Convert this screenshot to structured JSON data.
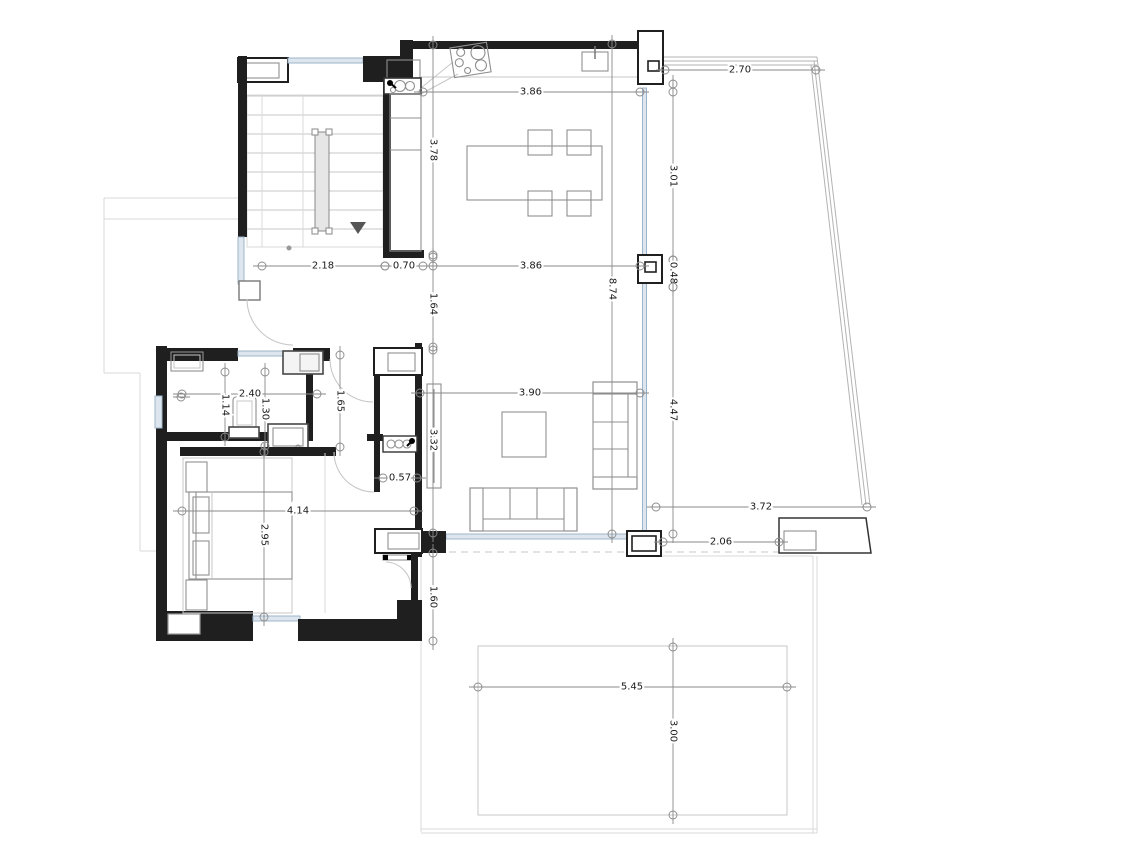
{
  "plan": {
    "type": "architectural-floor-plan",
    "units": "meters",
    "dimensions": [
      {
        "name": "terrace-north-width",
        "label": "2.70"
      },
      {
        "name": "dining-room-width-north",
        "label": "3.86"
      },
      {
        "name": "kitchen-run-length",
        "label": "3.78"
      },
      {
        "name": "terrace-east-upper",
        "label": "3.01"
      },
      {
        "name": "hall-width",
        "label": "2.18"
      },
      {
        "name": "kitchen-counter-depth",
        "label": "0.70"
      },
      {
        "name": "dining-room-width-south",
        "label": "3.86"
      },
      {
        "name": "east-pier-height",
        "label": "0.48"
      },
      {
        "name": "main-volume-depth",
        "label": "8.74"
      },
      {
        "name": "passage-width",
        "label": "1.64"
      },
      {
        "name": "terrace-east-lower",
        "label": "4.47"
      },
      {
        "name": "bathroom-width",
        "label": "2.40"
      },
      {
        "name": "bathroom-depth-left",
        "label": "1.14"
      },
      {
        "name": "bathroom-depth-right",
        "label": "1.30"
      },
      {
        "name": "corridor-length",
        "label": "1.65"
      },
      {
        "name": "living-room-width",
        "label": "3.90"
      },
      {
        "name": "living-room-depth",
        "label": "3.32"
      },
      {
        "name": "wc-width",
        "label": "0.57"
      },
      {
        "name": "bedroom-width",
        "label": "4.14"
      },
      {
        "name": "bedroom-depth",
        "label": "2.95"
      },
      {
        "name": "terrace-south-width",
        "label": "3.72"
      },
      {
        "name": "pergola-span",
        "label": "2.06"
      },
      {
        "name": "bedroom-terrace-offset",
        "label": "1.60"
      },
      {
        "name": "patio-width",
        "label": "5.45"
      },
      {
        "name": "patio-depth",
        "label": "3.00"
      }
    ],
    "colors": {
      "wall": "#1f1f1f",
      "furniture": "#8f8f8f",
      "dimension": "#8a8a8a",
      "glazing": "#9db4c8",
      "faint": "#d9d9d9",
      "background": "#ffffff"
    }
  }
}
